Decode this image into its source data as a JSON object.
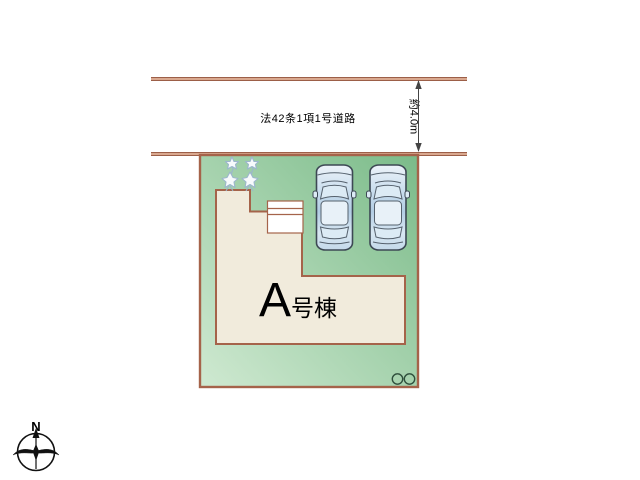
{
  "road": {
    "label": "法42条1項1号道路",
    "width_label": "約4.0m"
  },
  "building": {
    "label": "A号棟",
    "label_main": "A",
    "label_suffix": "号棟"
  },
  "plot": {
    "cars_count": 2,
    "trees_count": 2,
    "utility_circles_count": 2
  },
  "compass": {
    "north_label": "N"
  },
  "colors": {
    "road_line_dark": "#9c5f48",
    "road_line_light": "#d9a88f",
    "plot_border": "#a5634a",
    "grass_light": "#cfe9d1",
    "grass_dark": "#7bbb89",
    "building_fill": "#f1ebdc",
    "porch_fill": "#ffffff",
    "car_outline": "#3d4854",
    "tree_stroke": "#9cb6cc",
    "text_color": "#000000"
  }
}
